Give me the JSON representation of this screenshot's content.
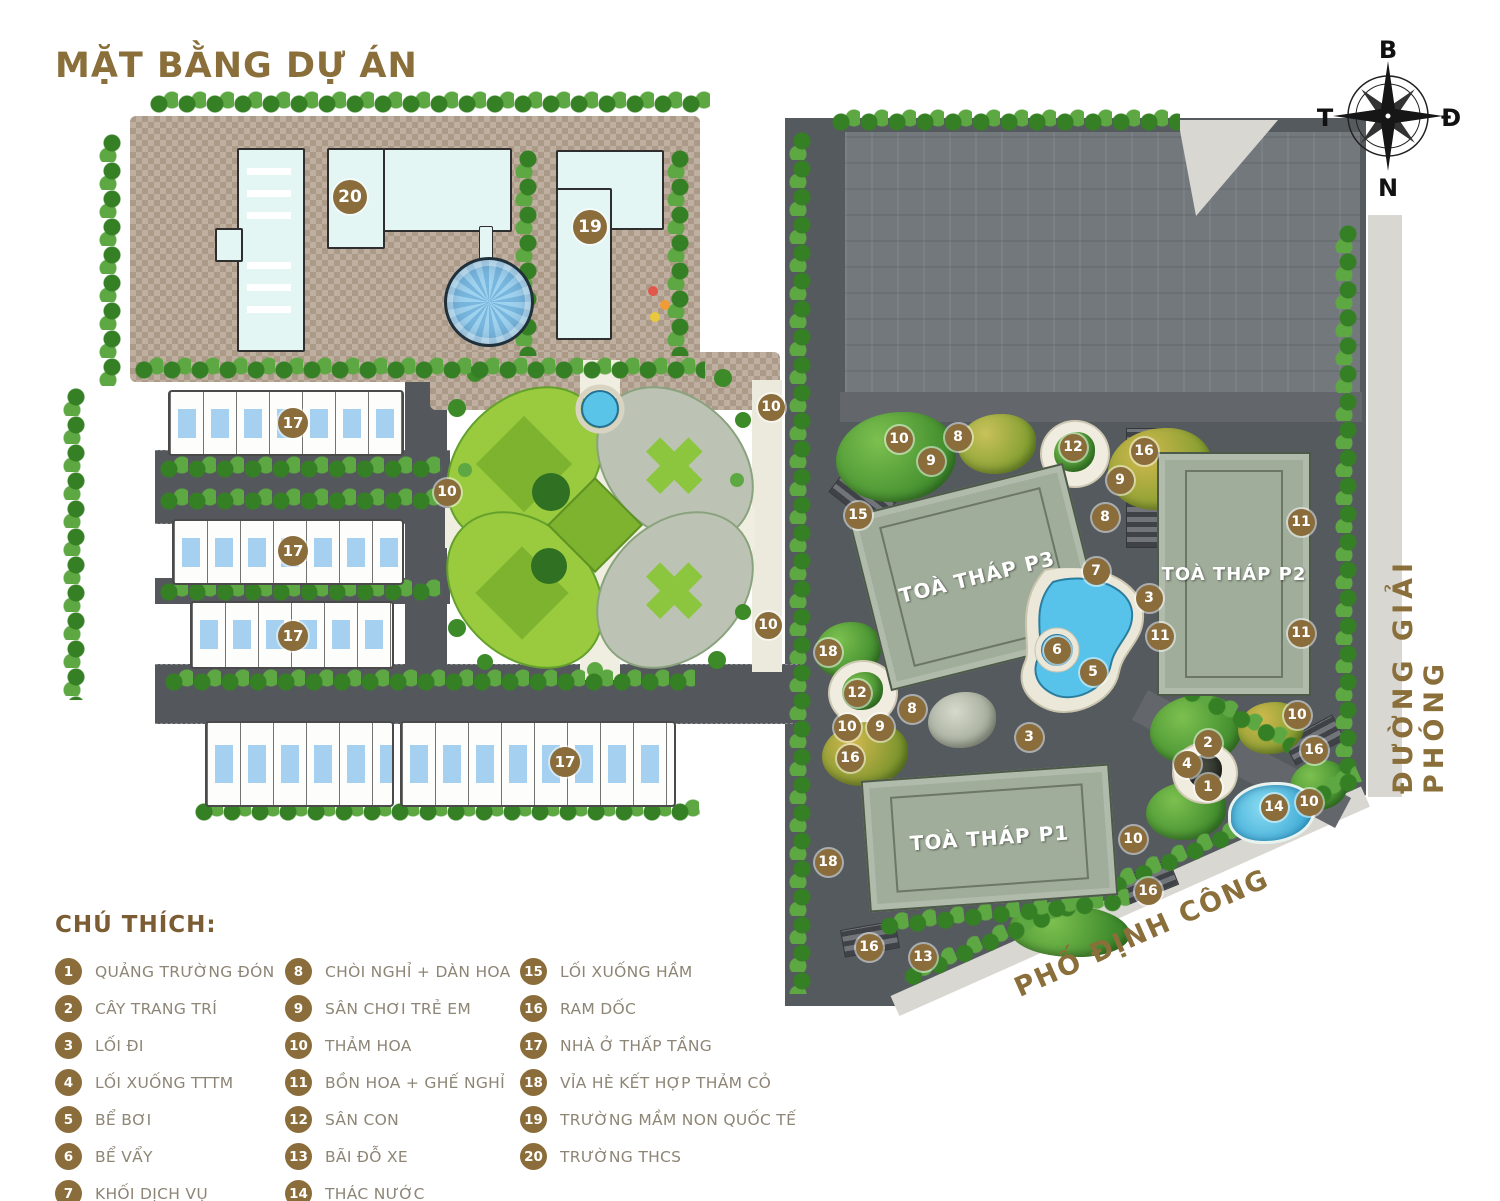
{
  "title": "MẶT BẰNG DỰ ÁN",
  "compass": {
    "north": "B",
    "east": "Đ",
    "south": "N",
    "west": "T"
  },
  "roads": {
    "giai_phong": "ĐƯỜNG GIẢI PHÓNG",
    "dinh_cong": "PHỐ ĐỊNH CÔNG"
  },
  "towers": {
    "p1": "TOÀ THÁP P1",
    "p2": "TOÀ THÁP P2",
    "p3": "TOÀ THÁP P3"
  },
  "colors": {
    "accent_brown": "#8a6d3b",
    "title_brown": "#8a6f3b",
    "legend_text": "#8d8575",
    "road_dark": "#54585c",
    "tower_green": "#a0ad9a",
    "water_blue": "#58c3ea",
    "garden_green": "#9aca3e",
    "plaza_tan": "#b3a08e",
    "building_cyan": "#e3f6f4"
  },
  "legend": {
    "heading": "CHÚ THÍCH:",
    "columns": [
      [
        {
          "n": "1",
          "label": "QUẢNG TRƯỜNG ĐÓN"
        },
        {
          "n": "2",
          "label": "CÂY TRANG TRÍ"
        },
        {
          "n": "3",
          "label": "LỐI ĐI"
        },
        {
          "n": "4",
          "label": "LỐI XUỐNG TTTM"
        },
        {
          "n": "5",
          "label": "BỂ BƠI"
        },
        {
          "n": "6",
          "label": "BỂ VẨY"
        },
        {
          "n": "7",
          "label": "KHỐI DỊCH VỤ"
        }
      ],
      [
        {
          "n": "8",
          "label": "CHÒI NGHỈ + DÀN HOA"
        },
        {
          "n": "9",
          "label": "SÂN CHƠI TRẺ EM"
        },
        {
          "n": "10",
          "label": "THẢM HOA"
        },
        {
          "n": "11",
          "label": "BỒN HOA + GHẾ NGHỈ"
        },
        {
          "n": "12",
          "label": "SÂN CON"
        },
        {
          "n": "13",
          "label": "BÃI ĐỖ XE"
        },
        {
          "n": "14",
          "label": "THÁC NƯỚC"
        }
      ],
      [
        {
          "n": "15",
          "label": "LỐI XUỐNG HẦM"
        },
        {
          "n": "16",
          "label": "RAM DỐC"
        },
        {
          "n": "17",
          "label": "NHÀ Ở THẤP TẦNG"
        },
        {
          "n": "18",
          "label": "VỈA HÈ KẾT HỢP THẢM CỎ"
        },
        {
          "n": "19",
          "label": "TRƯỜNG MẦM NON QUỐC TẾ"
        },
        {
          "n": "20",
          "label": "TRƯỜNG THCS"
        }
      ]
    ]
  },
  "map": {
    "markers": [
      {
        "n": "20",
        "x": 350,
        "y": 197,
        "s": 34
      },
      {
        "n": "19",
        "x": 590,
        "y": 227,
        "s": 34
      },
      {
        "n": "17",
        "x": 293,
        "y": 423,
        "s": 30
      },
      {
        "n": "17",
        "x": 293,
        "y": 551,
        "s": 30
      },
      {
        "n": "17",
        "x": 293,
        "y": 636,
        "s": 30
      },
      {
        "n": "17",
        "x": 565,
        "y": 762,
        "s": 30
      },
      {
        "n": "10",
        "x": 771,
        "y": 407
      },
      {
        "n": "10",
        "x": 447,
        "y": 492
      },
      {
        "n": "10",
        "x": 768,
        "y": 625
      },
      {
        "n": "10",
        "x": 899,
        "y": 439
      },
      {
        "n": "8",
        "x": 958,
        "y": 437
      },
      {
        "n": "9",
        "x": 931,
        "y": 461
      },
      {
        "n": "15",
        "x": 858,
        "y": 515
      },
      {
        "n": "12",
        "x": 1073,
        "y": 447
      },
      {
        "n": "16",
        "x": 1144,
        "y": 451
      },
      {
        "n": "9",
        "x": 1120,
        "y": 480
      },
      {
        "n": "8",
        "x": 1105,
        "y": 517
      },
      {
        "n": "7",
        "x": 1096,
        "y": 571
      },
      {
        "n": "3",
        "x": 1149,
        "y": 598
      },
      {
        "n": "11",
        "x": 1160,
        "y": 636
      },
      {
        "n": "6",
        "x": 1057,
        "y": 650
      },
      {
        "n": "5",
        "x": 1093,
        "y": 672
      },
      {
        "n": "11",
        "x": 1301,
        "y": 522
      },
      {
        "n": "11",
        "x": 1301,
        "y": 633
      },
      {
        "n": "18",
        "x": 828,
        "y": 652
      },
      {
        "n": "12",
        "x": 857,
        "y": 693
      },
      {
        "n": "10",
        "x": 847,
        "y": 727
      },
      {
        "n": "9",
        "x": 880,
        "y": 727
      },
      {
        "n": "8",
        "x": 912,
        "y": 709
      },
      {
        "n": "16",
        "x": 850,
        "y": 758
      },
      {
        "n": "3",
        "x": 1029,
        "y": 737
      },
      {
        "n": "10",
        "x": 1297,
        "y": 715
      },
      {
        "n": "16",
        "x": 1314,
        "y": 750
      },
      {
        "n": "2",
        "x": 1208,
        "y": 743
      },
      {
        "n": "4",
        "x": 1187,
        "y": 764
      },
      {
        "n": "1",
        "x": 1208,
        "y": 787
      },
      {
        "n": "14",
        "x": 1274,
        "y": 807
      },
      {
        "n": "10",
        "x": 1309,
        "y": 802
      },
      {
        "n": "10",
        "x": 1133,
        "y": 839
      },
      {
        "n": "18",
        "x": 828,
        "y": 862
      },
      {
        "n": "16",
        "x": 1148,
        "y": 891
      },
      {
        "n": "16",
        "x": 869,
        "y": 947
      },
      {
        "n": "13",
        "x": 923,
        "y": 957
      }
    ]
  }
}
